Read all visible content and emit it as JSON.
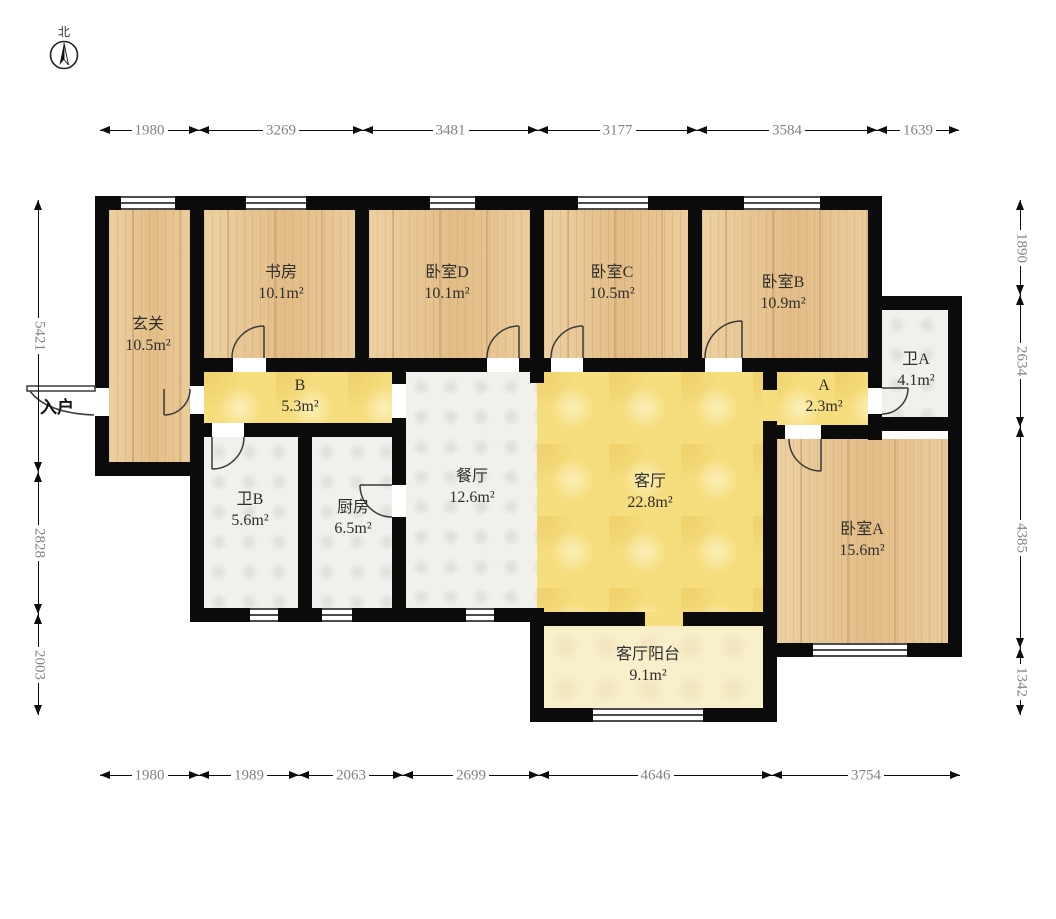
{
  "compass": {
    "north_label": "北"
  },
  "entry": {
    "label": "入户"
  },
  "rooms": {
    "xuanguan": {
      "name": "玄关",
      "area": "10.5m²"
    },
    "shufang": {
      "name": "书房",
      "area": "10.1m²"
    },
    "bedroomD": {
      "name": "卧室D",
      "area": "10.1m²"
    },
    "bedroomC": {
      "name": "卧室C",
      "area": "10.5m²"
    },
    "bedroomB": {
      "name": "卧室B",
      "area": "10.9m²"
    },
    "bathA": {
      "name": "卫A",
      "area": "4.1m²"
    },
    "hallB": {
      "name": "B",
      "area": "5.3m²"
    },
    "hallA": {
      "name": "A",
      "area": "2.3m²"
    },
    "bathB": {
      "name": "卫B",
      "area": "5.6m²"
    },
    "kitchen": {
      "name": "厨房",
      "area": "6.5m²"
    },
    "dining": {
      "name": "餐厅",
      "area": "12.6m²"
    },
    "living": {
      "name": "客厅",
      "area": "22.8m²"
    },
    "bedroomA": {
      "name": "卧室A",
      "area": "15.6m²"
    },
    "balcony": {
      "name": "客厅阳台",
      "area": "9.1m²"
    }
  },
  "dimensions": {
    "top": [
      "1980",
      "3269",
      "3481",
      "3177",
      "3584",
      "1639"
    ],
    "bottom": [
      "1980",
      "1989",
      "2063",
      "2699",
      "4646",
      "3754"
    ],
    "left": [
      "5421",
      "2828",
      "2003"
    ],
    "right": [
      "1890",
      "2634",
      "4385",
      "1342"
    ]
  },
  "colors": {
    "wall": "#0b0b0b",
    "living_floor": "#f6dd7e",
    "wood_floor": "#e8c794",
    "tile_floor": "#f1f0ec",
    "balcony_floor": "#f8efcb",
    "dim_text": "#838383"
  }
}
